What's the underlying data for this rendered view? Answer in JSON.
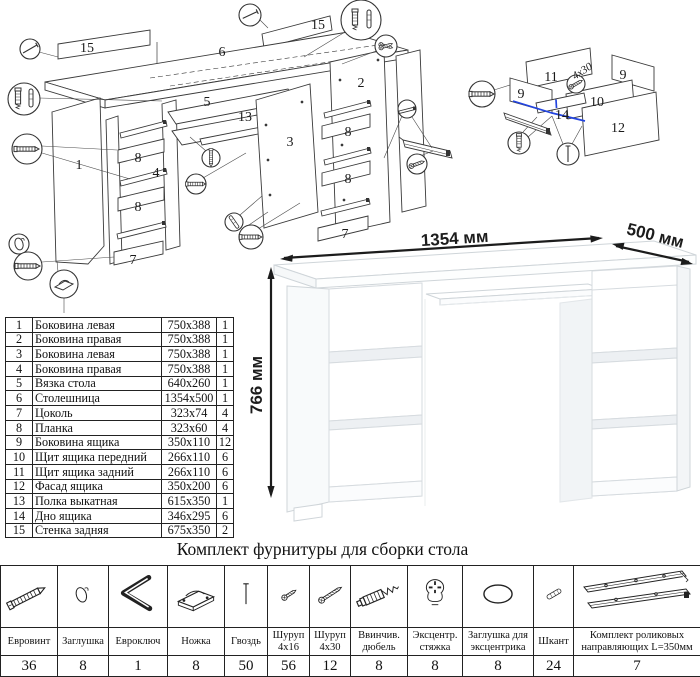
{
  "exploded": {
    "labels": {
      "p15l": "15",
      "p6": "6",
      "p15r": "15",
      "p5": "5",
      "p13": "13",
      "p3": "3",
      "p2": "2",
      "p1": "1",
      "p8a": "8",
      "p4": "4",
      "p8b": "8",
      "p7a": "7",
      "p8c": "8",
      "p8d": "8",
      "p7b": "7"
    }
  },
  "drawer_detail": {
    "labels": {
      "p11": "11",
      "p9a": "9",
      "p9b": "9",
      "p10": "10",
      "p14": "14",
      "p12": "12"
    },
    "screw_note": "4x30"
  },
  "dimensions": {
    "width": "1354 мм",
    "depth": "500 мм",
    "height": "766 мм"
  },
  "parts": [
    {
      "num": "1",
      "name": "Боковина левая",
      "size": "750x388",
      "qty": "1"
    },
    {
      "num": "2",
      "name": "Боковина правая",
      "size": "750x388",
      "qty": "1"
    },
    {
      "num": "3",
      "name": "Боковина левая",
      "size": "750x388",
      "qty": "1"
    },
    {
      "num": "4",
      "name": "Боковина правая",
      "size": "750x388",
      "qty": "1"
    },
    {
      "num": "5",
      "name": "Вязка стола",
      "size": "640x260",
      "qty": "1"
    },
    {
      "num": "6",
      "name": "Столешница",
      "size": "1354x500",
      "qty": "1"
    },
    {
      "num": "7",
      "name": "Цоколь",
      "size": "323x74",
      "qty": "4"
    },
    {
      "num": "8",
      "name": "Планка",
      "size": "323x60",
      "qty": "4"
    },
    {
      "num": "9",
      "name": "Боковина ящика",
      "size": "350x110",
      "qty": "12"
    },
    {
      "num": "10",
      "name": "Щит ящика передний",
      "size": "266x110",
      "qty": "6"
    },
    {
      "num": "11",
      "name": "Щит ящика задний",
      "size": "266x110",
      "qty": "6"
    },
    {
      "num": "12",
      "name": "Фасад ящика",
      "size": "350x200",
      "qty": "6"
    },
    {
      "num": "13",
      "name": "Полка выкатная",
      "size": "615x350",
      "qty": "1"
    },
    {
      "num": "14",
      "name": "Дно ящика",
      "size": "346x295",
      "qty": "6"
    },
    {
      "num": "15",
      "name": "Стенка задняя",
      "size": "675x350",
      "qty": "2"
    }
  ],
  "hardware": {
    "title": "Комплект фурнитуры для сборки стола",
    "items": [
      {
        "name": "Евровинт",
        "qty": "36",
        "icon": "euro"
      },
      {
        "name": "Заглушка",
        "qty": "8",
        "icon": "cap"
      },
      {
        "name": "Евроключ",
        "qty": "1",
        "icon": "hexkey"
      },
      {
        "name": "Ножка",
        "qty": "8",
        "icon": "foot"
      },
      {
        "name": "Гвоздь",
        "qty": "50",
        "icon": "nail"
      },
      {
        "name": "Шуруп 4x16",
        "qty": "56",
        "icon": "screw16"
      },
      {
        "name": "Шуруп 4x30",
        "qty": "12",
        "icon": "screw30"
      },
      {
        "name": "Ввинчив. дюбель",
        "qty": "8",
        "icon": "dowelscrew"
      },
      {
        "name": "Эксцентр. стяжка",
        "qty": "8",
        "icon": "camlock"
      },
      {
        "name": "Заглушка для эксцентрика",
        "qty": "8",
        "icon": "camcap"
      },
      {
        "name": "Шкант",
        "qty": "24",
        "icon": "pin"
      },
      {
        "name": "Комплект роликовых направляющих L=350мм",
        "qty": "7",
        "icon": "rails"
      }
    ]
  }
}
